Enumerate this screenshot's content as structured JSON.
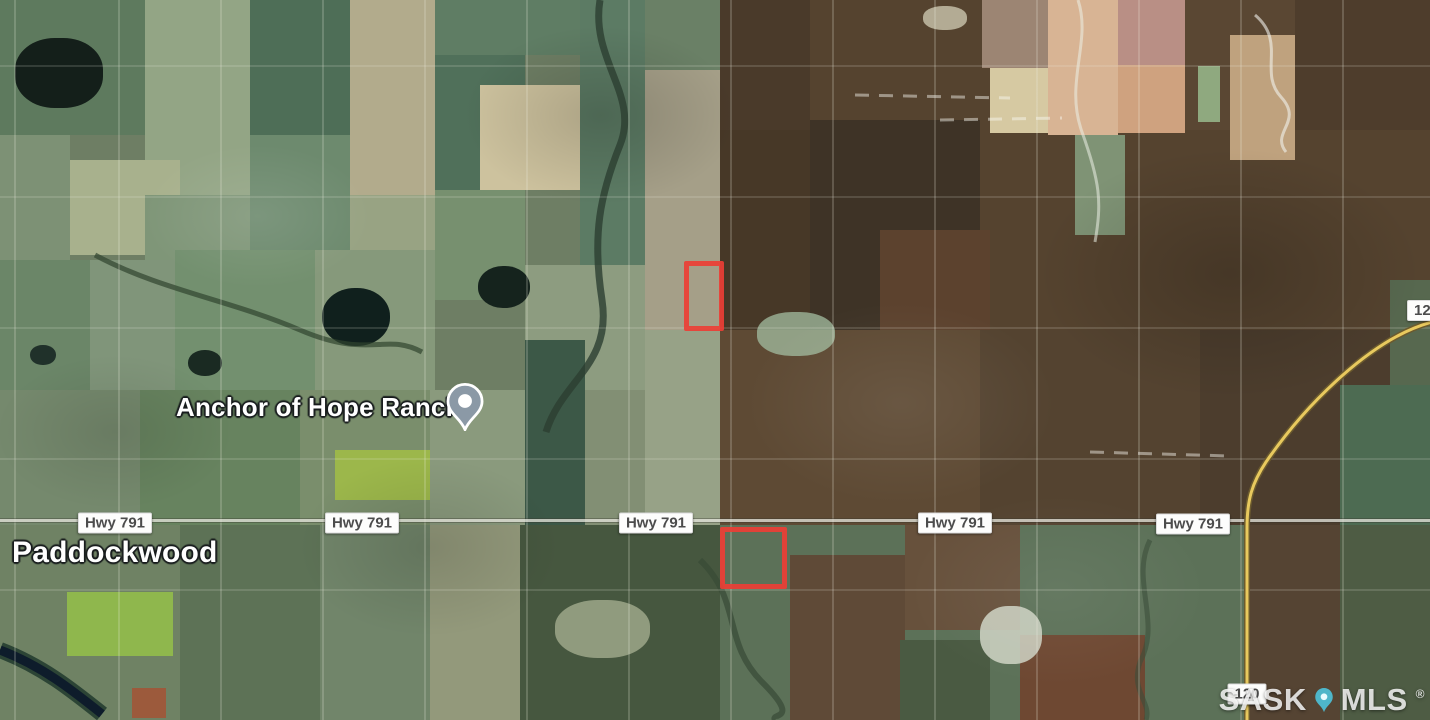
{
  "labels": {
    "place": "Anchor of Hope Ranch",
    "town": "Paddockwood"
  },
  "highway_shields": [
    {
      "label": "Hwy 791"
    },
    {
      "label": "Hwy 791"
    },
    {
      "label": "Hwy 791"
    },
    {
      "label": "Hwy 791"
    },
    {
      "label": "Hwy 791"
    }
  ],
  "route_shields": {
    "bottom": "120",
    "right_edge_clipped": "120"
  },
  "watermark": {
    "left": "SASK",
    "right": "MLS",
    "registered": "®"
  },
  "icons": {
    "place_pin": "map-pin",
    "watermark_pin": "map-pin"
  },
  "colors": {
    "highlight_red": "#ec3e35",
    "highway_yellow": "#e8c95e",
    "pin_gray": "#8b99a6",
    "watermark_pin_teal": "#4ec3da",
    "shield_text": "#4c4c4c"
  }
}
